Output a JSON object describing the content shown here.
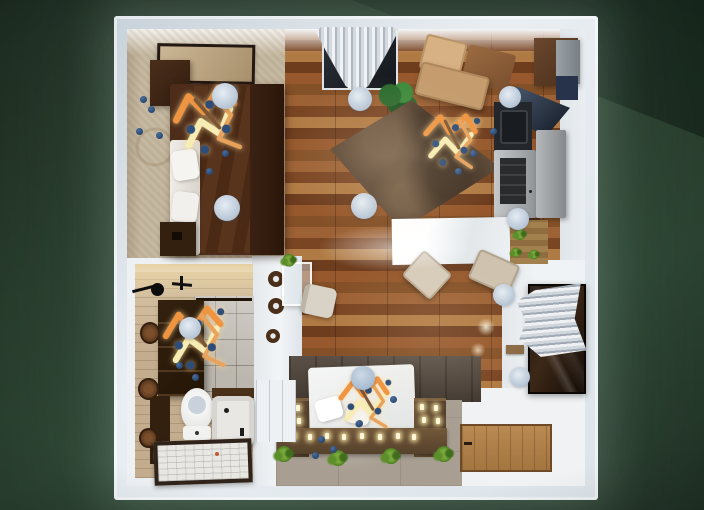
{
  "scene": {
    "title": "Studio apartment - overhead 3D floor plan render",
    "style": "3d-render-top-down",
    "background_color": "#24362a",
    "wall_color": "#dfe6ec",
    "floors": {
      "living_kitchen": "hardwood planks #8a5330",
      "bedroom": "beige carpet #c6b9a1",
      "bathroom": "light wood tile #c3ad8e",
      "lounge_platform": "stone #a89f92"
    },
    "rooms": [
      {
        "name": "bedroom",
        "position": "top-left",
        "items": [
          "double bed with dark brown duvet",
          "white sheet and pillows",
          "dark headboard",
          "nightstand top",
          "nightstand bottom",
          "framed wall picture",
          "ceiling lamp x2",
          "zigzag garland decor",
          "scattered navy beads"
        ]
      },
      {
        "name": "living-kitchen",
        "position": "top-right",
        "items": [
          "window with white curtain",
          "potted plant",
          "L-shaped tan sofa",
          "brown area rug",
          "tall brown cabinet",
          "navy range hood",
          "black sink counter",
          "stainless cooktop oven",
          "refrigerator",
          "lower brown counter",
          "white dining table",
          "upholstered chair x2",
          "wood counter with small plants",
          "ceiling lamp x3",
          "zigzag garland decor"
        ]
      },
      {
        "name": "bathroom",
        "position": "bottom-left",
        "items": [
          "black towel fixtures",
          "dark storage shelf",
          "stone tile shower wall",
          "round wall basket x3",
          "toilet",
          "bathtub with dark ledge",
          "framed floor mat",
          "ceiling lamp",
          "zigzag garland decor"
        ]
      },
      {
        "name": "hallway-nook",
        "position": "center-left",
        "items": [
          "white shelf wall",
          "decor plate x3",
          "glass console with plant",
          "beige chair",
          "white cabinet"
        ]
      },
      {
        "name": "lounge-nook",
        "position": "bottom-center",
        "items": [
          "stone accent wall",
          "white platform mattress with pillows",
          "pendant lamp disc",
          "U-shaped planter with candles",
          "fern x4",
          "zigzag garland decor",
          "scattered navy beads"
        ]
      },
      {
        "name": "entry",
        "position": "bottom-right",
        "items": [
          "dark framed mirror panel",
          "striped curtain",
          "small wall shelf",
          "wooden door laid flat",
          "ceiling lamp x2",
          "floor light glow x2"
        ]
      }
    ],
    "decor_colors": {
      "zigzag_orange": "#ef9440",
      "zigzag_yellow": "#f7edb4",
      "zigzag_tan": "#e8a25c",
      "beads_navy": "#2e4d78",
      "candle_glow": "#ffe9a8",
      "lamp_disc": "#b9c7d7"
    }
  }
}
